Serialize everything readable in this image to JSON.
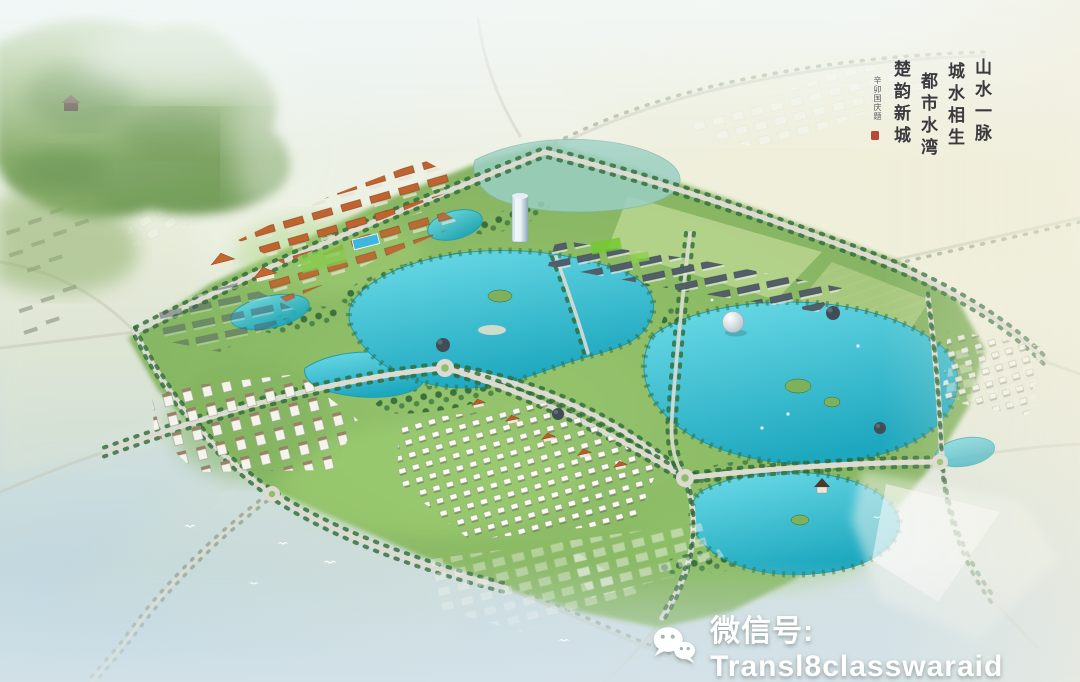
{
  "calligraphy": {
    "lines": [
      "山水一脉",
      "城水相生",
      "都市水湾",
      "楚韵新城"
    ],
    "signature": "辛卯国庆题",
    "seal": "red-seal",
    "ink": "#2b2a30",
    "seal_red": "#b23a28"
  },
  "watermark": {
    "icon": "wechat-icon",
    "label": "微信号: Transl8classwaraid",
    "color": "#ffffff"
  },
  "palette": {
    "sky_haze": "#e8f1f2",
    "warm_haze": "#f4efdc",
    "field_pale": "#e7ead1",
    "park_green": "#85b661",
    "bright_green": "#9ed06f",
    "tree_green": "#2e6a38",
    "lake_teal": "#2fb9cd",
    "lake_light": "#7edce8",
    "road_gray": "#dcdbd1",
    "roof_orange": "#bf6330",
    "roof_slate": "#525e69",
    "water_wash": "#bcd5df",
    "ink": "#2b2a30",
    "seal_red": "#b23a28",
    "watermark_white": "#ffffff"
  }
}
